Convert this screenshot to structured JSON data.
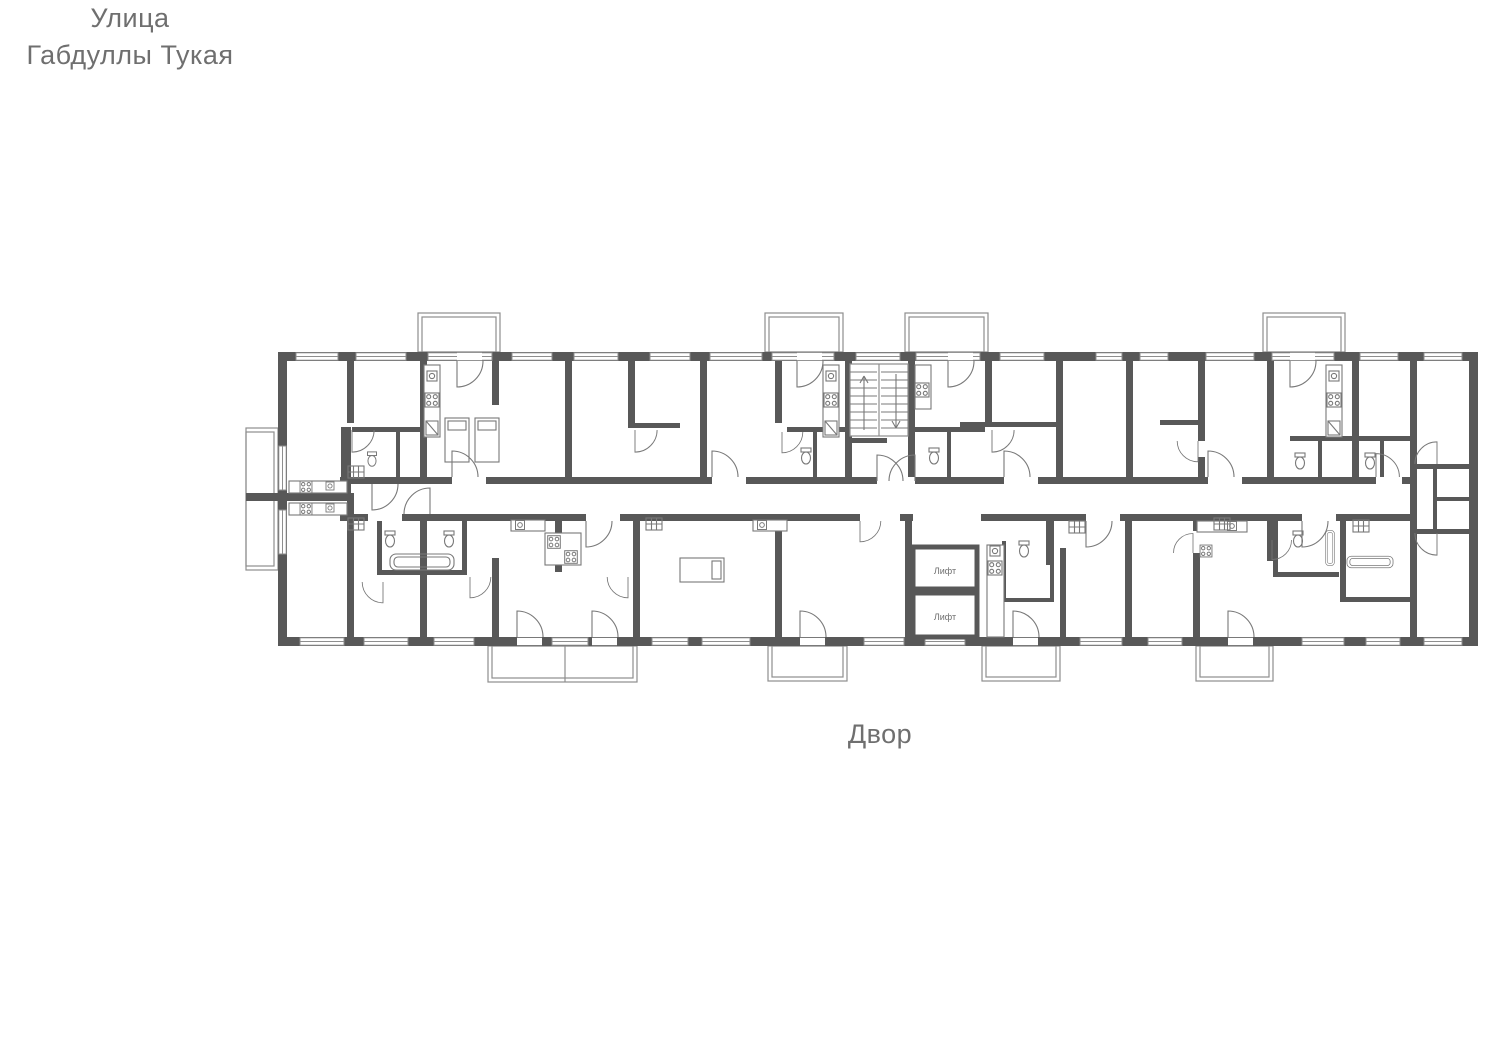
{
  "labels": {
    "street_line1": "Улица",
    "street_line2": "Габдуллы Тукая",
    "courtyard": "Двор",
    "elevator_1": "Лифт",
    "elevator_2": "Лифт"
  },
  "colors": {
    "wall": "#585858",
    "line": "#8e8e8e",
    "fixline": "#787878",
    "label_text": "#6f6f6f",
    "background": "#ffffff"
  }
}
